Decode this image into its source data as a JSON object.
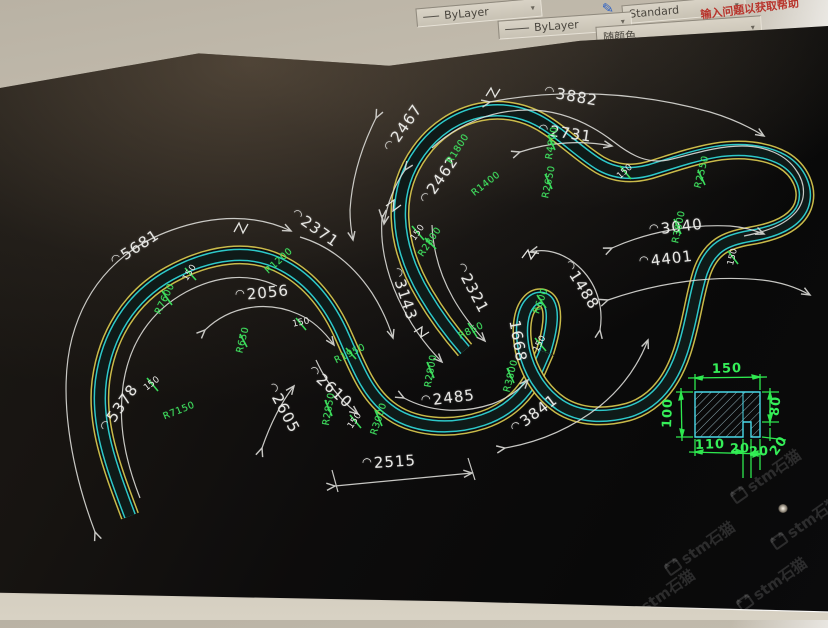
{
  "window": {
    "help_text": "输入问题以获取帮助"
  },
  "toolbar": {
    "linetype_control_1": "ByLayer",
    "text_style_control": "Standard",
    "linetype_control_2": "ByLayer",
    "plot_style_control": "随颜色"
  },
  "watermark": {
    "text": "stm石猫",
    "positions": [
      {
        "x": 766,
        "y": 476
      },
      {
        "x": 700,
        "y": 548
      },
      {
        "x": 772,
        "y": 584
      },
      {
        "x": 660,
        "y": 596
      },
      {
        "x": 806,
        "y": 522
      }
    ]
  },
  "drawing": {
    "labels": [
      {
        "text": "3882",
        "arc": true,
        "x": 571,
        "y": 96,
        "rot": 10,
        "cls": "dim"
      },
      {
        "text": "2467",
        "arc": true,
        "x": 403,
        "y": 128,
        "rot": -55,
        "cls": "dim"
      },
      {
        "text": "2462",
        "arc": true,
        "x": 439,
        "y": 180,
        "rot": -55,
        "cls": "dim"
      },
      {
        "text": "2731",
        "arc": true,
        "x": 565,
        "y": 133,
        "rot": 8,
        "cls": "dim"
      },
      {
        "text": "3040",
        "arc": true,
        "x": 676,
        "y": 227,
        "rot": -7,
        "cls": "dim"
      },
      {
        "text": "4401",
        "arc": true,
        "x": 666,
        "y": 259,
        "rot": -7,
        "cls": "dim"
      },
      {
        "text": "2371",
        "arc": true,
        "x": 315,
        "y": 228,
        "rot": 35,
        "cls": "dim"
      },
      {
        "text": "5681",
        "arc": true,
        "x": 135,
        "y": 248,
        "rot": -33,
        "cls": "dim"
      },
      {
        "text": "2056",
        "arc": true,
        "x": 262,
        "y": 293,
        "rot": -6,
        "cls": "dim"
      },
      {
        "text": "3143",
        "arc": true,
        "x": 404,
        "y": 294,
        "rot": 72,
        "cls": "dim"
      },
      {
        "text": "2321",
        "arc": true,
        "x": 472,
        "y": 288,
        "rot": 62,
        "cls": "dim"
      },
      {
        "text": "1488",
        "arc": true,
        "x": 581,
        "y": 285,
        "rot": 58,
        "cls": "dim"
      },
      {
        "text": "1668",
        "arc": false,
        "x": 518,
        "y": 341,
        "rot": 80,
        "cls": "dim"
      },
      {
        "text": "3841",
        "arc": true,
        "x": 534,
        "y": 414,
        "rot": -37,
        "cls": "dim"
      },
      {
        "text": "2485",
        "arc": true,
        "x": 448,
        "y": 398,
        "rot": -7,
        "cls": "dim"
      },
      {
        "text": "2515",
        "arc": true,
        "x": 389,
        "y": 462,
        "rot": -4,
        "cls": "dim"
      },
      {
        "text": "2610",
        "arc": true,
        "x": 330,
        "y": 387,
        "rot": 42,
        "cls": "dim"
      },
      {
        "text": "2605",
        "arc": true,
        "x": 283,
        "y": 408,
        "rot": 62,
        "cls": "dim"
      },
      {
        "text": "5378",
        "arc": true,
        "x": 119,
        "y": 408,
        "rot": -55,
        "cls": "dim"
      },
      {
        "text": "R1800",
        "x": 458,
        "y": 149,
        "rot": -58,
        "cls": "rad"
      },
      {
        "text": "R1400",
        "x": 486,
        "y": 184,
        "rot": -38,
        "cls": "rad"
      },
      {
        "text": "R4800",
        "x": 552,
        "y": 143,
        "rot": -80,
        "cls": "rad"
      },
      {
        "text": "R2650",
        "x": 549,
        "y": 182,
        "rot": -78,
        "cls": "rad"
      },
      {
        "text": "R2550",
        "x": 702,
        "y": 172,
        "rot": -76,
        "cls": "rad"
      },
      {
        "text": "R3800",
        "x": 679,
        "y": 227,
        "rot": -78,
        "cls": "rad"
      },
      {
        "text": "R1200",
        "x": 279,
        "y": 261,
        "rot": -42,
        "cls": "rad"
      },
      {
        "text": "R7600",
        "x": 165,
        "y": 299,
        "rot": -64,
        "cls": "rad"
      },
      {
        "text": "R650",
        "x": 243,
        "y": 340,
        "rot": -76,
        "cls": "rad"
      },
      {
        "text": "R7150",
        "x": 179,
        "y": 411,
        "rot": -22,
        "cls": "rad"
      },
      {
        "text": "R850",
        "x": 471,
        "y": 331,
        "rot": -26,
        "cls": "rad"
      },
      {
        "text": "R600",
        "x": 541,
        "y": 301,
        "rot": -70,
        "cls": "rad"
      },
      {
        "text": "R1950",
        "x": 350,
        "y": 354,
        "rot": -26,
        "cls": "rad"
      },
      {
        "text": "R2800",
        "x": 431,
        "y": 371,
        "rot": -80,
        "cls": "rad"
      },
      {
        "text": "R2800",
        "x": 430,
        "y": 242,
        "rot": -56,
        "cls": "rad"
      },
      {
        "text": "R2850",
        "x": 329,
        "y": 409,
        "rot": -80,
        "cls": "rad"
      },
      {
        "text": "R3000",
        "x": 379,
        "y": 419,
        "rot": -72,
        "cls": "rad"
      },
      {
        "text": "R3800",
        "x": 511,
        "y": 376,
        "rot": -76,
        "cls": "rad"
      },
      {
        "text": "150",
        "x": 418,
        "y": 233,
        "rot": -55,
        "cls": "w150"
      },
      {
        "text": "150",
        "x": 190,
        "y": 273,
        "rot": -58,
        "cls": "w150"
      },
      {
        "text": "150",
        "x": 301,
        "y": 323,
        "rot": -12,
        "cls": "w150"
      },
      {
        "text": "150",
        "x": 152,
        "y": 384,
        "rot": -38,
        "cls": "w150"
      },
      {
        "text": "150",
        "x": 355,
        "y": 421,
        "rot": -55,
        "cls": "w150"
      },
      {
        "text": "150",
        "x": 540,
        "y": 344,
        "rot": -62,
        "cls": "w150"
      },
      {
        "text": "150",
        "x": 625,
        "y": 172,
        "rot": -42,
        "cls": "w150"
      },
      {
        "text": "150",
        "x": 733,
        "y": 257,
        "rot": -76,
        "cls": "w150"
      }
    ]
  },
  "detail": {
    "labels": [
      {
        "text": "150",
        "x": 727,
        "y": 369,
        "rot": -2,
        "cls": "det"
      },
      {
        "text": "100",
        "x": 668,
        "y": 413,
        "rot": -88,
        "cls": "det"
      },
      {
        "text": "80",
        "x": 776,
        "y": 406,
        "rot": -84,
        "cls": "det"
      },
      {
        "text": "110",
        "x": 710,
        "y": 445,
        "rot": -2,
        "cls": "det"
      },
      {
        "text": "20",
        "x": 740,
        "y": 449,
        "rot": -2,
        "cls": "det"
      },
      {
        "text": "20",
        "x": 759,
        "y": 452,
        "rot": -2,
        "cls": "det"
      },
      {
        "text": "20",
        "x": 779,
        "y": 446,
        "rot": -55,
        "cls": "det"
      }
    ]
  }
}
